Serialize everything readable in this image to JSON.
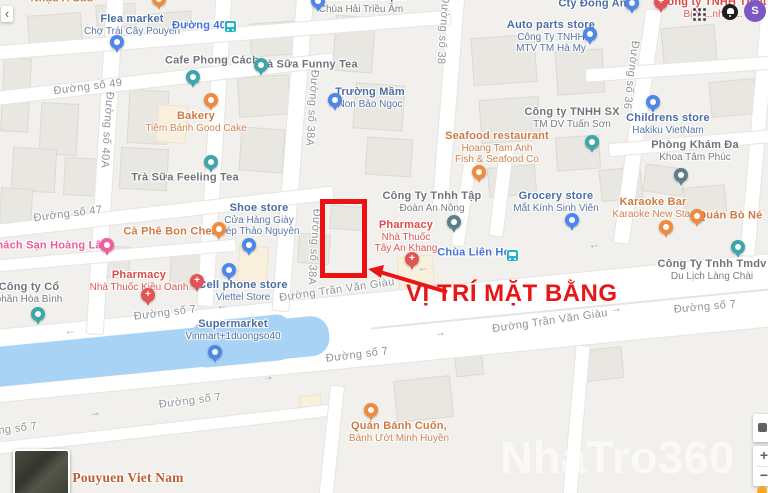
{
  "annotation": {
    "text": "VỊ TRÍ MẶT BẰNG",
    "color": "#e81616"
  },
  "watermark": "NhaTro360",
  "ui": {
    "back_glyph": "‹",
    "zoom_in": "+",
    "zoom_out": "−",
    "avatar_letter": "S"
  },
  "colors": {
    "land": "#f1f0ec",
    "road": "#ffffff",
    "water": "#a9d3f5",
    "building": "#e9e7e2",
    "building_cream": "#f8f0dd",
    "annotation_red": "#e81616",
    "highlight_box": "#ea1212",
    "label_shop": "#4a6da2",
    "label_generic": "#6f7479",
    "label_food": "#cf7a43",
    "label_health": "#dd4a46",
    "label_hotel": "#ec5b9c",
    "label_transit": "#4272d8",
    "label_area": "#bf5b33",
    "label_street": "#8f9398",
    "pin_shop": "#4e86ec",
    "pin_generic": "#3da6ab",
    "pin_food": "#ef8b3f",
    "pin_health": "#e25353",
    "pin_hotel": "#f0609f",
    "pin_dark": "#5d7f8b",
    "transit_icon": "#25b3c5",
    "avatar_bg": "#7e57c2",
    "watermark_color": "rgba(255,255,255,0.62)"
  },
  "pois": [
    {
      "id": "nhau-a-sau",
      "type": "food",
      "label": {
        "x": 62,
        "y": -1,
        "lines": [
          "Nhậu A Sáu"
        ]
      },
      "marker": null
    },
    {
      "id": "unlabeled-food-pin",
      "type": "food",
      "label": null,
      "marker": {
        "x": 159,
        "y": -8
      }
    },
    {
      "id": "flea-market",
      "type": "shop",
      "label": {
        "x": 132,
        "y": 25,
        "lines": [
          "Flea market",
          "Chợ Trái Cây Pouyen"
        ]
      },
      "marker": {
        "x": 117,
        "y": 35
      }
    },
    {
      "id": "duong-40-stop",
      "type": "transit",
      "label": {
        "x": 199,
        "y": 26,
        "lines": [
          "Đường 40"
        ]
      },
      "marker": {
        "x": 230,
        "y": 21
      }
    },
    {
      "id": "buddhist-temple",
      "type": "generic",
      "pin": "shop",
      "label": {
        "x": 361,
        "y": 3,
        "lines": [
          "Buddhist Temple",
          "Chùa Hải Triều Âm"
        ]
      },
      "marker": {
        "x": 318,
        "y": -6
      }
    },
    {
      "id": "cafe-phong-cach",
      "type": "generic",
      "label": {
        "x": 212,
        "y": 61,
        "lines": [
          "Cafe Phong Cách"
        ]
      },
      "marker": {
        "x": 193,
        "y": 70
      }
    },
    {
      "id": "tra-sua-funny-tea",
      "type": "generic",
      "label": {
        "x": 307,
        "y": 65,
        "lines": [
          "Trà Sữa Funny Tea"
        ]
      },
      "marker": {
        "x": 261,
        "y": 58
      }
    },
    {
      "id": "bakery",
      "type": "food",
      "label": {
        "x": 196,
        "y": 122,
        "lines": [
          "Bakery",
          "Tiệm Bánh Good Cake"
        ]
      },
      "marker": {
        "x": 211,
        "y": 93
      }
    },
    {
      "id": "truong-mam-non",
      "type": "shop",
      "label": {
        "x": 370,
        "y": 98,
        "lines": [
          "Trường Mầm",
          "Non Bảo Ngọc"
        ]
      },
      "marker": {
        "x": 335,
        "y": 93
      }
    },
    {
      "id": "tra-sua-feeling-tea",
      "type": "generic",
      "label": {
        "x": 185,
        "y": 178,
        "lines": [
          "Trà Sữa Feeling Tea"
        ]
      },
      "marker": {
        "x": 211,
        "y": 155
      }
    },
    {
      "id": "khach-san-hoang-lam",
      "type": "hotel",
      "label": {
        "x": 50,
        "y": 246,
        "lines": [
          "Khách Sạn Hoàng Lâm"
        ]
      },
      "marker": {
        "x": 107,
        "y": 238
      }
    },
    {
      "id": "ca-phe-bon-chen",
      "type": "food",
      "label": {
        "x": 171,
        "y": 232,
        "lines": [
          "Cà Phê Bon Chen"
        ]
      },
      "marker": {
        "x": 219,
        "y": 222
      }
    },
    {
      "id": "shoe-store",
      "type": "shop",
      "label": {
        "x": 259,
        "y": 220,
        "lines": [
          "Shoe store",
          "Cửa Hàng Giày",
          "Dép Thảo Nguyên"
        ]
      },
      "marker": {
        "x": 249,
        "y": 238
      }
    },
    {
      "id": "pharmacy-kieu-oanh",
      "type": "health",
      "label": {
        "x": 139,
        "y": 281,
        "lines": [
          "Pharmacy",
          "Nhà Thuốc Kiều Oanh"
        ]
      },
      "marker": {
        "x": 148,
        "y": 288
      }
    },
    {
      "id": "unlabeled-health-pin",
      "type": "health",
      "label": null,
      "marker": {
        "x": 197,
        "y": 274
      }
    },
    {
      "id": "cell-phone-store",
      "type": "shop",
      "label": {
        "x": 243,
        "y": 291,
        "lines": [
          "Cell phone store",
          "Viettel Store"
        ]
      },
      "marker": {
        "x": 229,
        "y": 263
      }
    },
    {
      "id": "cong-ty-hoa-binh",
      "type": "generic",
      "label": {
        "x": 29,
        "y": 293,
        "lines": [
          "Công ty Cổ",
          "phần Hòa Bình"
        ]
      },
      "marker": {
        "x": 38,
        "y": 307
      }
    },
    {
      "id": "supermarket-vinmart",
      "type": "shop",
      "label": {
        "x": 233,
        "y": 330,
        "lines": [
          "Supermarket",
          "Vinmart+1duongso40"
        ]
      },
      "marker": {
        "x": 215,
        "y": 345
      }
    },
    {
      "id": "auto-parts-store",
      "type": "shop",
      "label": {
        "x": 551,
        "y": 37,
        "lines": [
          "Auto parts store",
          "Công Ty TNHH",
          "MTV TM Hà My"
        ]
      },
      "marker": {
        "x": 590,
        "y": 27
      }
    },
    {
      "id": "cty-dong-anh",
      "type": "shop",
      "label": {
        "x": 596,
        "y": 4,
        "lines": [
          "Cty Đông Anh"
        ]
      },
      "marker": {
        "x": 632,
        "y": -4
      }
    },
    {
      "id": "thiet-bi-y-te",
      "type": "health",
      "label": {
        "x": 713,
        "y": 8,
        "lines": [
          "Công ty TNHH Thiết",
          "Bị Y ...nh G..."
        ]
      },
      "marker": {
        "x": 661,
        "y": -5
      }
    },
    {
      "id": "seafood-restaurant",
      "type": "food",
      "label": {
        "x": 497,
        "y": 148,
        "lines": [
          "Seafood restaurant",
          "Hoang Tam Anh",
          "Fish & Seafood Co"
        ]
      },
      "marker": {
        "x": 479,
        "y": 165
      }
    },
    {
      "id": "tuan-son",
      "type": "generic",
      "label": {
        "x": 572,
        "y": 118,
        "lines": [
          "Công ty TNHH SX",
          "TM DV Tuấn Sơn"
        ]
      },
      "marker": {
        "x": 592,
        "y": 135
      }
    },
    {
      "id": "grocery-store",
      "type": "shop",
      "label": {
        "x": 556,
        "y": 202,
        "lines": [
          "Grocery store",
          "Mắt Kính Sinh Viên"
        ]
      },
      "marker": {
        "x": 572,
        "y": 213
      }
    },
    {
      "id": "an-nong",
      "type": "generic",
      "pin": "dark",
      "label": {
        "x": 432,
        "y": 202,
        "lines": [
          "Công Ty Tnhh Tập",
          "Đoàn An Nông"
        ]
      },
      "marker": {
        "x": 454,
        "y": 215
      }
    },
    {
      "id": "childrens-store",
      "type": "shop",
      "label": {
        "x": 668,
        "y": 124,
        "lines": [
          "Childrens store",
          "Hakiku VietNam"
        ]
      },
      "marker": {
        "x": 653,
        "y": 95
      }
    },
    {
      "id": "phong-kham",
      "type": "generic",
      "pin": "dark",
      "label": {
        "x": 695,
        "y": 151,
        "lines": [
          "Phòng Khám Đa",
          "Khoa Tâm Phúc"
        ]
      },
      "marker": {
        "x": 681,
        "y": 168
      }
    },
    {
      "id": "karaoke-new-star",
      "type": "food",
      "label": {
        "x": 653,
        "y": 208,
        "lines": [
          "Karaoke Bar",
          "Karaoke New Star"
        ]
      },
      "marker": {
        "x": 666,
        "y": 220
      }
    },
    {
      "id": "quan-bo-ne",
      "type": "food",
      "label": {
        "x": 730,
        "y": 216,
        "lines": [
          "Quán Bò Né"
        ]
      },
      "marker": {
        "x": 697,
        "y": 209
      }
    },
    {
      "id": "pharmacy-tay-an-khang",
      "type": "health",
      "label": {
        "x": 406,
        "y": 237,
        "lines": [
          "Pharmacy",
          "Nhà Thuốc",
          "Tây An Khang"
        ]
      },
      "marker": {
        "x": 412,
        "y": 252
      }
    },
    {
      "id": "chua-lien-hoa-stop",
      "type": "transit",
      "label": {
        "x": 477,
        "y": 253,
        "lines": [
          "Chùa Liên Hoa"
        ]
      },
      "marker": {
        "x": 512,
        "y": 250
      }
    },
    {
      "id": "tmdv-lang-chai",
      "type": "generic",
      "label": {
        "x": 712,
        "y": 270,
        "lines": [
          "Công Ty Tnhh Tmdv",
          "Du Lịch Làng Chài"
        ]
      },
      "marker": {
        "x": 738,
        "y": 240
      }
    },
    {
      "id": "quan-banh-cuon",
      "type": "food",
      "label": {
        "x": 399,
        "y": 432,
        "lines": [
          "Quán Bánh Cuốn,",
          "Bánh Ướt Minh Huyền"
        ]
      },
      "marker": {
        "x": 371,
        "y": 403
      }
    },
    {
      "id": "pouyuen-viet-nam",
      "type": "area",
      "label": {
        "x": 128,
        "y": 478,
        "lines": [
          "Pouyuen Viet Nam"
        ]
      },
      "marker": null
    }
  ],
  "street_labels": [
    {
      "text": "Đường số 49",
      "x": 88,
      "y": 87,
      "rot": -7
    },
    {
      "text": "Đường số 40A",
      "x": 107,
      "y": 130,
      "rot": 94
    },
    {
      "text": "Đường số 38A",
      "x": 312,
      "y": 108,
      "rot": 94
    },
    {
      "text": "Đường số 38A",
      "x": 314,
      "y": 247,
      "rot": 94
    },
    {
      "text": "Đường số 38",
      "x": 443,
      "y": 30,
      "rot": 94
    },
    {
      "text": "Đường số 36",
      "x": 631,
      "y": 75,
      "rot": 97
    },
    {
      "text": "Đường số 47",
      "x": 68,
      "y": 214,
      "rot": -7
    },
    {
      "text": "Đường số 7",
      "x": 165,
      "y": 313,
      "rot": -7
    },
    {
      "text": "Đường Trần Văn Giàu",
      "x": 337,
      "y": 290,
      "rot": -8
    },
    {
      "text": "Đường Trần Văn Giàu",
      "x": 550,
      "y": 321,
      "rot": -8
    },
    {
      "text": "Đường số 7",
      "x": 705,
      "y": 307,
      "rot": -5
    },
    {
      "text": "Đường số 7",
      "x": 357,
      "y": 355,
      "rot": -7
    },
    {
      "text": "Đường số 7",
      "x": 190,
      "y": 401,
      "rot": -7
    },
    {
      "text": "Đường số 7",
      "x": 6,
      "y": 430,
      "rot": -7
    }
  ],
  "oneway_arrows": [
    {
      "x": 222,
      "y": 306,
      "dir": "←"
    },
    {
      "x": 70,
      "y": 331,
      "dir": "←"
    },
    {
      "x": 423,
      "y": 268,
      "dir": "←"
    },
    {
      "x": 594,
      "y": 245,
      "dir": "←"
    },
    {
      "x": 616,
      "y": 309,
      "dir": "→"
    },
    {
      "x": 268,
      "y": 377,
      "dir": "→"
    },
    {
      "x": 95,
      "y": 413,
      "dir": "→"
    },
    {
      "x": 440,
      "y": 333,
      "dir": "→"
    }
  ]
}
